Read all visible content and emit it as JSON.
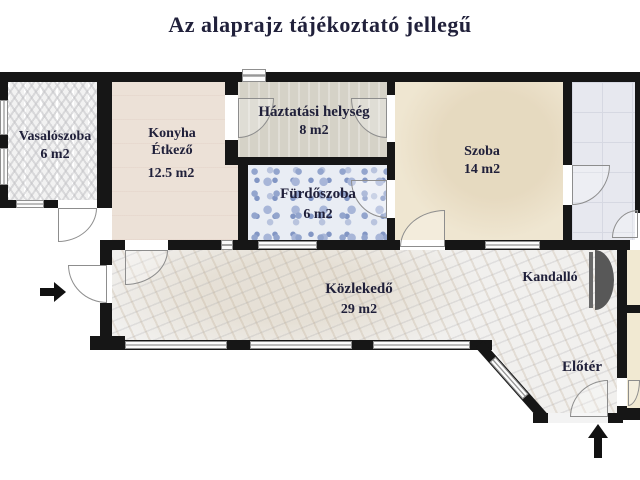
{
  "title": "Az alaprajz tájékoztató jellegű",
  "rooms": {
    "vasaloszoba": {
      "name": "Vasalószoba",
      "area": "6 m2"
    },
    "konyha": {
      "line1": "Konyha",
      "line2": "Étkező",
      "area": "12.5 m2"
    },
    "haztartasi": {
      "name": "Háztatási helység",
      "area": "8 m2"
    },
    "furdoszoba": {
      "name": "Fürdőszoba",
      "area": "6 m2"
    },
    "szoba": {
      "name": "Szoba",
      "area": "14 m2"
    },
    "kozlekedo": {
      "name": "Közlekedő",
      "area": "29 m2"
    },
    "kandallo": {
      "name": "Kandalló"
    },
    "eloter": {
      "name": "Előtér"
    }
  },
  "icons": {
    "entrance_side": "arrow-right",
    "entrance_main": "arrow-up",
    "fireplace": "fireplace-half-disc"
  },
  "colors": {
    "wall": "#161616",
    "title_text": "#21213b",
    "label_text": "#20203a",
    "vasalo_floor": "#f2f2f2",
    "konyha_floor": "#ece1d7",
    "haztartasi_floor": "#d5d2c7",
    "furdo_floor": "#e9edf4",
    "szoba_floor": "#efe6d1",
    "grayroom_floor": "#e7e8ef",
    "marble_floor": "#f1f0ee",
    "side_room_floor": "#f1e9d2",
    "fireplace": "#585858"
  }
}
